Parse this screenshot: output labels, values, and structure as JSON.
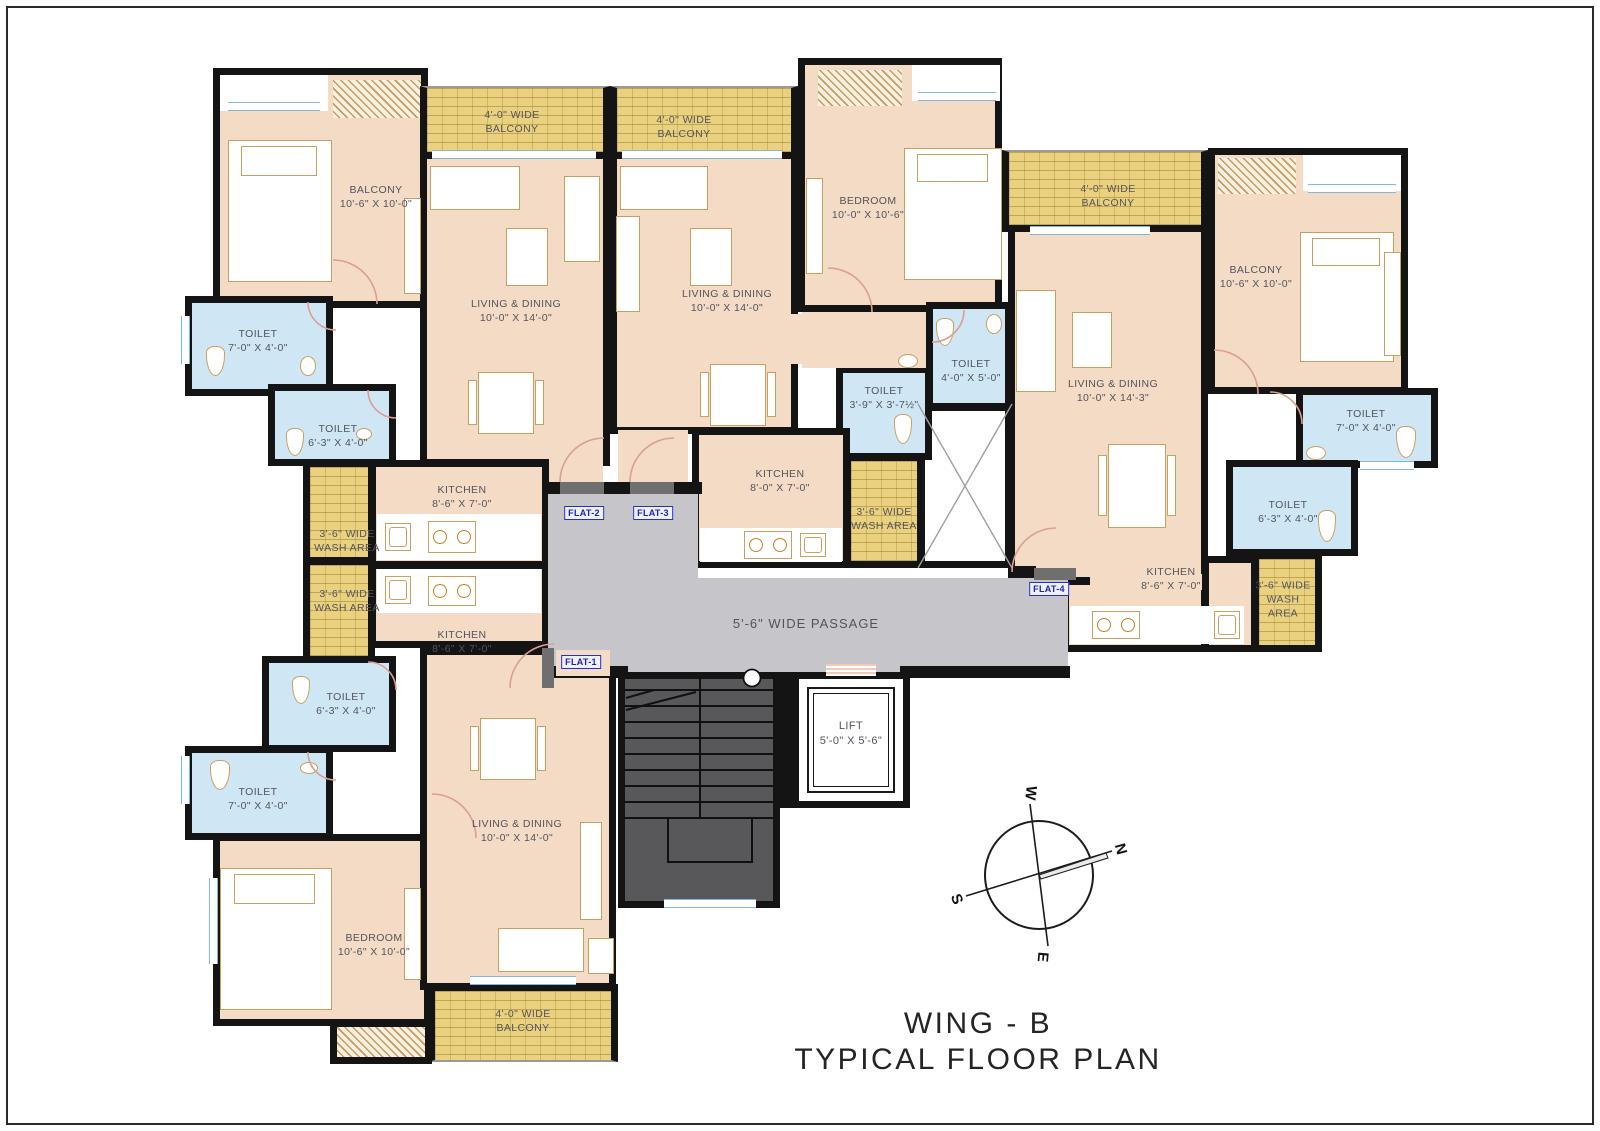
{
  "title": {
    "line1": "WING - B",
    "line2": "TYPICAL FLOOR PLAN"
  },
  "passage": {
    "label": "5'-6\" WIDE PASSAGE"
  },
  "lift": {
    "name": "LIFT",
    "dim": "5'-0\" X 5'-6\""
  },
  "tags": {
    "flat1": "FLAT-1",
    "flat2": "FLAT-2",
    "flat3": "FLAT-3",
    "flat4": "FLAT-4"
  },
  "compass": {
    "n": "N",
    "s": "S",
    "e": "E",
    "w": "W"
  },
  "labels": {
    "f2_bedroom": {
      "lines": [
        "BALCONY",
        "10'-6\" X 10'-0\""
      ]
    },
    "f2_balcony": {
      "lines": [
        "4'-0\" WIDE",
        "BALCONY"
      ]
    },
    "f2_toilet_a": {
      "lines": [
        "TOILET",
        "7'-0\" X 4'-0\""
      ]
    },
    "f2_toilet_b": {
      "lines": [
        "TOILET",
        "6'-3\" X 4'-0\""
      ]
    },
    "f2_living": {
      "lines": [
        "LIVING & DINING",
        "10'-0\" X 14'-0\""
      ]
    },
    "f2_kitchen": {
      "lines": [
        "KITCHEN",
        "8'-6\" X 7'-0\""
      ]
    },
    "f2_wash": {
      "lines": [
        "3'-6\" WIDE",
        "WASH AREA"
      ]
    },
    "f1_wash": {
      "lines": [
        "3'-6\" WIDE",
        "WASH AREA"
      ]
    },
    "f1_kitchen": {
      "lines": [
        "KITCHEN",
        "8'-6\" X 7'-0\""
      ]
    },
    "f1_toilet_a": {
      "lines": [
        "TOILET",
        "6'-3\" X 4'-0\""
      ]
    },
    "f1_toilet_b": {
      "lines": [
        "TOILET",
        "7'-0\" X 4'-0\""
      ]
    },
    "f1_bedroom": {
      "lines": [
        "BEDROOM",
        "10'-6\" X 10'-0\""
      ]
    },
    "f1_living": {
      "lines": [
        "LIVING & DINING",
        "10'-0\" X 14'-0\""
      ]
    },
    "f1_balcony": {
      "lines": [
        "4'-0\" WIDE",
        "BALCONY"
      ]
    },
    "f3_balcony": {
      "lines": [
        "4'-0\" WIDE",
        "BALCONY"
      ]
    },
    "f3_living": {
      "lines": [
        "LIVING & DINING",
        "10'-0\" X 14'-0\""
      ]
    },
    "f3_bedroom": {
      "lines": [
        "BEDROOM",
        "10'-0\" X 10'-6\""
      ]
    },
    "f3_toilet_a": {
      "lines": [
        "TOILET",
        "3'-9\" X 3'-7½\""
      ]
    },
    "f3_toilet_b": {
      "lines": [
        "TOILET",
        "4'-0\" X 5'-0\""
      ]
    },
    "f3_kitchen": {
      "lines": [
        "KITCHEN",
        "8'-0\" X 7'-0\""
      ]
    },
    "f3_wash": {
      "lines": [
        "3'-6\" WIDE",
        "WASH AREA"
      ]
    },
    "f4_balcony": {
      "lines": [
        "4'-0\" WIDE",
        "BALCONY"
      ]
    },
    "f4_bedroom": {
      "lines": [
        "BALCONY",
        "10'-6\" X 10'-0\""
      ]
    },
    "f4_living": {
      "lines": [
        "LIVING & DINING",
        "10'-0\" X 14'-3\""
      ]
    },
    "f4_toilet_a": {
      "lines": [
        "TOILET",
        "7'-0\" X 4'-0\""
      ]
    },
    "f4_toilet_b": {
      "lines": [
        "TOILET",
        "6'-3\" X 4'-0\""
      ]
    },
    "f4_kitchen": {
      "lines": [
        "KITCHEN",
        "8'-6\" X 7'-0\""
      ]
    },
    "f4_wash": {
      "lines": [
        "3'-6\" WIDE",
        "WASH",
        "AREA"
      ]
    }
  }
}
